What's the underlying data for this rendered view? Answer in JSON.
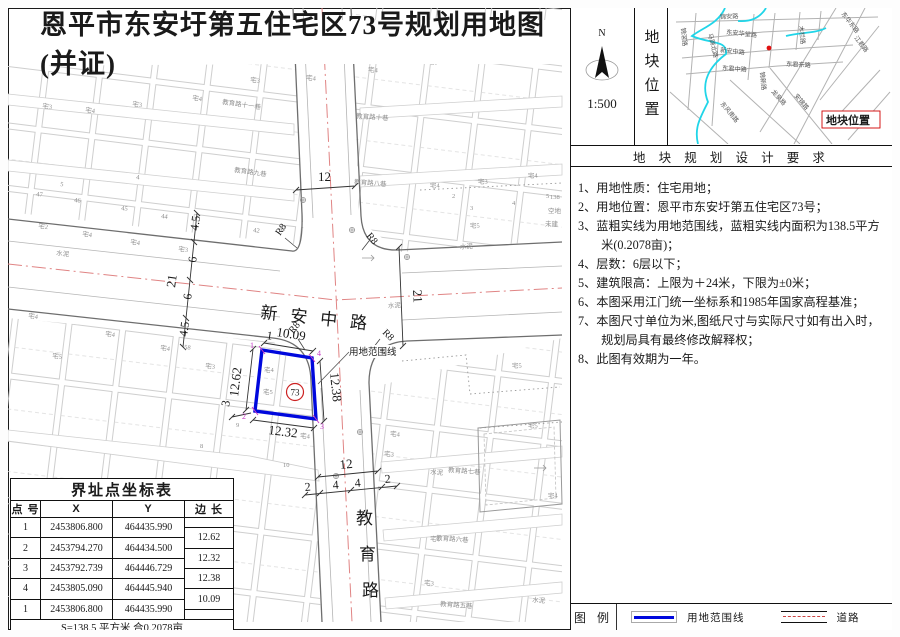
{
  "title": "恩平市东安圩第五住宅区73号规划用地图(并证)",
  "compass": {
    "n": "N",
    "scale": "1:500"
  },
  "location_panel": {
    "vertical_label": "地块位置",
    "marker_label": "地块位置",
    "streets": [
      {
        "t": "锦安路",
        "x": 52,
        "y": 11,
        "r": -3
      },
      {
        "t": "东安华堂路",
        "x": 58,
        "y": 26,
        "r": 6
      },
      {
        "t": "新安中路",
        "x": 52,
        "y": 44,
        "r": 6
      },
      {
        "t": "东君中路",
        "x": 54,
        "y": 62,
        "r": 4
      },
      {
        "t": "东君东路",
        "x": 118,
        "y": 58,
        "r": 3
      },
      {
        "t": "木栏路",
        "x": 131,
        "y": 18,
        "r": 84
      },
      {
        "t": "东华东路",
        "x": 173,
        "y": 6,
        "r": 52
      },
      {
        "t": "江君路",
        "x": 186,
        "y": 30,
        "r": 52
      },
      {
        "t": "锦滘路",
        "x": 13,
        "y": 20,
        "r": 84
      },
      {
        "t": "马蹄北路",
        "x": 40,
        "y": 26,
        "r": 76
      },
      {
        "t": "锦新路",
        "x": 92,
        "y": 64,
        "r": 84
      },
      {
        "t": "龙泉路",
        "x": 103,
        "y": 84,
        "r": 48
      },
      {
        "t": "东风南路",
        "x": 52,
        "y": 96,
        "r": 50
      },
      {
        "t": "安锦路",
        "x": 126,
        "y": 88,
        "r": 50
      }
    ]
  },
  "requirements": {
    "header": "地 块 规 划 设 计 要 求",
    "items": [
      "1、用地性质：住宅用地；",
      "2、用地位置：恩平市东安圩第五住宅区73号；",
      "3、蓝粗实线为用地范围线，蓝粗实线内面积为138.5平方米(0.2078亩)；",
      "4、层数：6层以下；",
      "5、建筑限高：上限为＋24米，下限为±0米；",
      "6、本图采用江门统一坐标系和1985年国家高程基准；",
      "7、本图尺寸单位为米,图纸尺寸与实际尺寸如有出入时，规划局具有最终修改解释权；",
      "8、此图有效期为一年。"
    ]
  },
  "legend": {
    "title": "图 例",
    "boundary_label": "用地范围线",
    "road_label": "道路"
  },
  "coord_table": {
    "title": "界址点坐标表",
    "headers": [
      "点 号",
      "X",
      "Y",
      "边 长"
    ],
    "rows": [
      {
        "id": "1",
        "x": "2453806.800",
        "y": "464435.990"
      },
      {
        "id": "2",
        "x": "2453794.270",
        "y": "464434.500"
      },
      {
        "id": "3",
        "x": "2453792.739",
        "y": "464446.729"
      },
      {
        "id": "4",
        "x": "2453805.090",
        "y": "464445.940"
      },
      {
        "id": "1",
        "x": "2453806.800",
        "y": "464435.990"
      }
    ],
    "edges": [
      "12.62",
      "12.32",
      "12.38",
      "10.09"
    ],
    "footer": "S=138.5 平方米 合0.2078亩"
  },
  "map": {
    "road_names": {
      "xinan": "新安中路",
      "jiaoyu": [
        "教",
        "育",
        "路"
      ]
    },
    "plot": {
      "number": "73",
      "boundary_label": "用地范围线",
      "corner_labels": [
        "1",
        "2",
        "3",
        "4"
      ]
    },
    "dims": {
      "plot_top": "10.09",
      "plot_left": "12.62",
      "plot_right": "12.38",
      "plot_bottom": "12.32",
      "tick_one": "1",
      "side_small": "3",
      "left_chain": [
        "4.5",
        "6",
        "6",
        "4.5"
      ],
      "left_total": "21",
      "right_total": "21",
      "road_top": "12",
      "road_bottom_total": "12",
      "bottom_chain": [
        "2",
        "4",
        "4",
        "2"
      ],
      "radius": "R8"
    },
    "texture_labels": [
      {
        "t": "教育路十一巷",
        "x": 222,
        "y": 104,
        "r": 8
      },
      {
        "t": "教育路九巷",
        "x": 234,
        "y": 172,
        "r": 8
      },
      {
        "t": "教育路十巷",
        "x": 356,
        "y": 118,
        "r": 4
      },
      {
        "t": "教育路八巷",
        "x": 354,
        "y": 184,
        "r": 4
      },
      {
        "t": "教育路七巷",
        "x": 448,
        "y": 472,
        "r": 4
      },
      {
        "t": "教育路六巷",
        "x": 436,
        "y": 540,
        "r": 4
      },
      {
        "t": "教育路五巷",
        "x": 440,
        "y": 606,
        "r": 4
      },
      {
        "t": "水泥",
        "x": 56,
        "y": 255,
        "r": 7
      },
      {
        "t": "水泥",
        "x": 460,
        "y": 249,
        "r": -3
      },
      {
        "t": "水泥",
        "x": 430,
        "y": 474,
        "r": 4
      },
      {
        "t": "水泥",
        "x": 532,
        "y": 602,
        "r": 4
      },
      {
        "t": "水泥",
        "x": 388,
        "y": 308,
        "r": -3
      },
      {
        "t": "空地",
        "x": 548,
        "y": 213
      },
      {
        "t": "未建",
        "x": 545,
        "y": 226
      },
      {
        "t": "138",
        "x": 550,
        "y": 199,
        "s": 11,
        "c": "#555"
      },
      {
        "t": "宅3",
        "x": 42,
        "y": 108,
        "r": 7
      },
      {
        "t": "宅4",
        "x": 85,
        "y": 112,
        "r": 7
      },
      {
        "t": "宅3",
        "x": 132,
        "y": 106,
        "r": 7
      },
      {
        "t": "宅4",
        "x": 192,
        "y": 100,
        "r": 7
      },
      {
        "t": "宅3",
        "x": 250,
        "y": 82,
        "r": 5
      },
      {
        "t": "宅4",
        "x": 306,
        "y": 80,
        "r": 3
      },
      {
        "t": "宅4",
        "x": 368,
        "y": 72,
        "r": 2
      },
      {
        "t": "宅5",
        "x": 428,
        "y": 64,
        "r": 2
      },
      {
        "t": "宅4",
        "x": 488,
        "y": 58,
        "r": 2
      },
      {
        "t": "宅3",
        "x": 540,
        "y": 52,
        "r": 2
      },
      {
        "t": "5",
        "x": 60,
        "y": 186,
        "r": 7
      },
      {
        "t": "4",
        "x": 136,
        "y": 179,
        "r": 7
      },
      {
        "t": "宅2",
        "x": 38,
        "y": 228,
        "r": 7
      },
      {
        "t": "宅4",
        "x": 82,
        "y": 236,
        "r": 7
      },
      {
        "t": "宅4",
        "x": 130,
        "y": 244,
        "r": 7
      },
      {
        "t": "宅3",
        "x": 178,
        "y": 251,
        "r": 7
      },
      {
        "t": "47",
        "x": 36,
        "y": 196,
        "r": 7
      },
      {
        "t": "46",
        "x": 74,
        "y": 202,
        "r": 7
      },
      {
        "t": "45",
        "x": 121,
        "y": 210,
        "r": 7
      },
      {
        "t": "44",
        "x": 161,
        "y": 218,
        "r": 7
      },
      {
        "t": "42",
        "x": 253,
        "y": 232,
        "r": 7
      },
      {
        "t": "41",
        "x": 279,
        "y": 230,
        "r": 7
      },
      {
        "t": "宅4",
        "x": 430,
        "y": 188,
        "r": -2
      },
      {
        "t": "宅3",
        "x": 478,
        "y": 184,
        "r": -2
      },
      {
        "t": "宅4",
        "x": 528,
        "y": 178,
        "r": -2
      },
      {
        "t": "宅5",
        "x": 470,
        "y": 228,
        "r": -2
      },
      {
        "t": "2",
        "x": 452,
        "y": 198
      },
      {
        "t": "3",
        "x": 470,
        "y": 210
      },
      {
        "t": "4",
        "x": 512,
        "y": 205
      },
      {
        "t": "5",
        "x": 546,
        "y": 198
      },
      {
        "t": "宅4",
        "x": 28,
        "y": 318,
        "r": 6
      },
      {
        "t": "宅5",
        "x": 52,
        "y": 358,
        "r": 6
      },
      {
        "t": "宅4",
        "x": 105,
        "y": 336,
        "r": 6
      },
      {
        "t": "宅4",
        "x": 160,
        "y": 350,
        "r": 6
      },
      {
        "t": "宅3",
        "x": 205,
        "y": 368,
        "r": 6
      },
      {
        "t": "宅4",
        "x": 264,
        "y": 372
      },
      {
        "t": "宅5",
        "x": 263,
        "y": 394
      },
      {
        "t": "58",
        "x": 184,
        "y": 349,
        "r": 6
      },
      {
        "t": "8",
        "x": 200,
        "y": 448
      },
      {
        "t": "9",
        "x": 236,
        "y": 427
      },
      {
        "t": "10",
        "x": 283,
        "y": 467
      },
      {
        "t": "宅4",
        "x": 300,
        "y": 438,
        "r": 3
      },
      {
        "t": "宅4",
        "x": 390,
        "y": 436,
        "r": 3
      },
      {
        "t": "宅3",
        "x": 384,
        "y": 456,
        "r": 3
      },
      {
        "t": "宅5",
        "x": 512,
        "y": 368,
        "r": -2
      },
      {
        "t": "宅4",
        "x": 430,
        "y": 541,
        "r": 3
      },
      {
        "t": "宅3",
        "x": 424,
        "y": 585,
        "r": 3
      },
      {
        "t": "宅5",
        "x": 528,
        "y": 428,
        "r": -2
      },
      {
        "t": "宅4",
        "x": 548,
        "y": 498,
        "r": -2
      }
    ]
  }
}
